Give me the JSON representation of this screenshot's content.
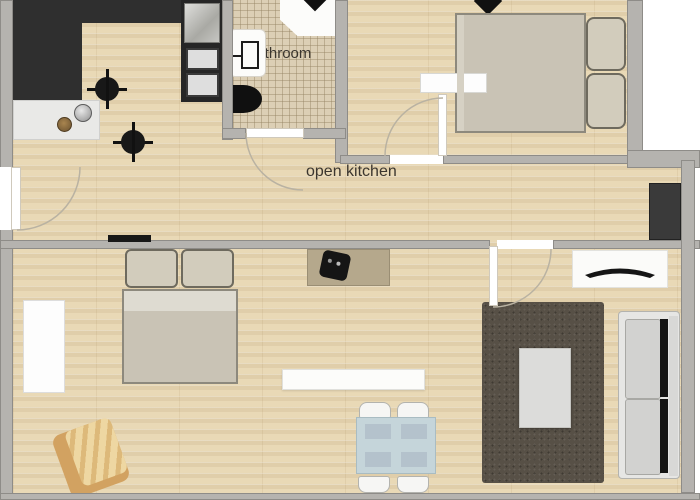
{
  "title": "apartment floor plan",
  "labels": {
    "bathroom": "bathroom",
    "open_kitchen": "open kitchen"
  },
  "rooms": [
    "kitchen",
    "bathroom",
    "bedroom-top-right",
    "open-kitchen-hallway",
    "bedroom-bottom-left",
    "dining-area",
    "living-room"
  ],
  "furniture": [
    "kitchen-counter",
    "kitchen-sink",
    "stove-burner",
    "oven-stack",
    "shower",
    "bathroom-sink",
    "toilet",
    "double-bed",
    "wardrobe",
    "armchair",
    "desk",
    "desk-chair",
    "shelf",
    "dining-table",
    "dining-chair",
    "rug",
    "coffee-table",
    "sofa",
    "tv-stand",
    "tv",
    "tall-cabinet",
    "radiator",
    "ceiling-lamp"
  ],
  "colors": {
    "wall": "#b5b3af",
    "wall_edge": "#8e8c88",
    "floor": "#e9d9b6",
    "tile": "#dccfb5",
    "counter_black": "#2f2f2f",
    "counter_white": "#e9e9e7",
    "appliance_dark": "#262626",
    "bed_mattress": "#c9c3b5",
    "bed_outline": "#8d897d",
    "pillow": "#d2ccbc",
    "wardrobe_white": "#fdfdfd",
    "rug": "#575046",
    "coffee_table": "#dcdcda",
    "sofa": "#e6e6e4",
    "sofa_cushion": "#d2d2d0",
    "tv_stand": "#fbfbf9",
    "dining_table": "#c5d5da",
    "chair_white": "#f6f6f4",
    "desk": "#b5a88c",
    "desk_chair": "#151515",
    "armchair": "#d2a261",
    "armchair_cushion": "#eed7a2",
    "dark_cabinet": "#3a3a3a",
    "label_text": "#3b362f",
    "door_arc": "#b9b2a2"
  }
}
